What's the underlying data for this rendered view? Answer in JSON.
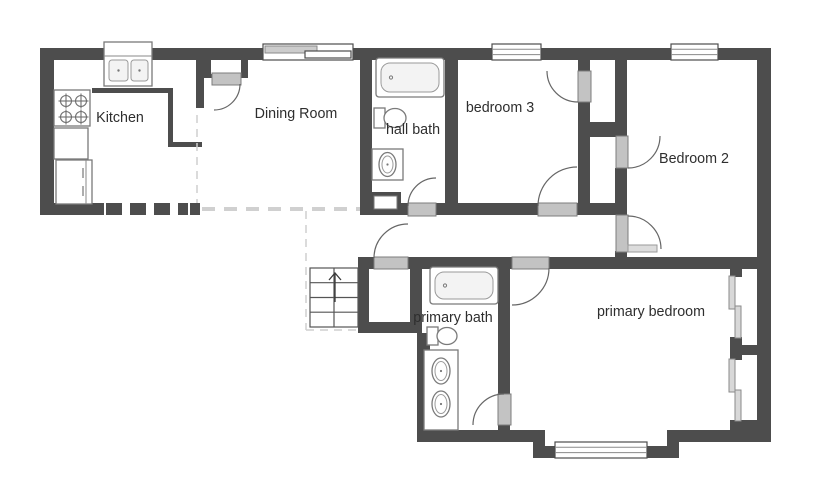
{
  "colors": {
    "wall": "#4d4d4d",
    "door_panel": "#c3c3c3",
    "door_leaf": "#dcdcdc",
    "window_sash": "#cccccc",
    "fixture_stroke": "#7a7a7a",
    "dashed_line": "#d0d0d0",
    "label_text": "#2e2e2e",
    "background": "#ffffff"
  },
  "rooms": {
    "kitchen": "Kitchen",
    "dining": "Dining Room",
    "hall_bath": "hall bath",
    "bedroom3": "bedroom 3",
    "bedroom2": "Bedroom 2",
    "primary_bath": "primary bath",
    "primary_bedroom": "primary bedroom"
  },
  "stairs": {
    "direction_arrow": "up",
    "steps": 4
  },
  "fixtures": {
    "kitchen": [
      "double-basin-sink",
      "range-4-burners",
      "counter-cabinet",
      "refrigerator"
    ],
    "hall_bath": [
      "bathtub",
      "toilet",
      "vanity-sink",
      "linen-niche"
    ],
    "primary_bath": [
      "bathtub",
      "toilet",
      "double-vanity-sinks"
    ],
    "primary_bedroom": [
      "sliding-door-closet",
      "sliding-door-closet"
    ]
  },
  "windows": [
    "dining-room",
    "bedroom-3",
    "bedroom-2",
    "primary-bedroom"
  ],
  "doors": [
    "kitchen-dining",
    "hall-bath",
    "bedroom-3",
    "bedroom-3-closet",
    "bedroom-2-closet",
    "bedroom-2",
    "hall-closet",
    "primary-bedroom",
    "primary-bath"
  ]
}
